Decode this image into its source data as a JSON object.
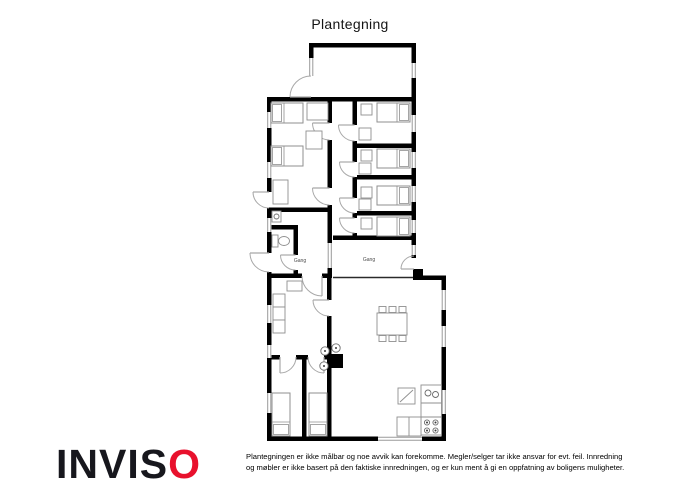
{
  "header": {
    "title": "Plantegning"
  },
  "footer": {
    "logo_text_black": "INVIS",
    "logo_text_red": "O",
    "logo_red_color": "#e8112d",
    "disclaimer_line1": "Plantegningen er ikke målbar og noe avvik kan forekomme. Megler/selger tar ikke ansvar for evt. feil. Innredning",
    "disclaimer_line2": "og møbler er ikke basert på den faktiske innredningen, og er kun ment å gi en oppfatning av boligens muligheter."
  },
  "floorplan": {
    "wall_color": "#000000",
    "window_color": "#9a9a9a",
    "door_color": "#a8a8a8",
    "furniture_color": "#8f8f8f",
    "label_color": "#4a4a4a",
    "walls": [
      {
        "x": 309,
        "y": 43,
        "w": 107,
        "h": 4.5
      },
      {
        "x": 309,
        "y": 47.5,
        "w": 4.5,
        "h": 10.5
      },
      {
        "x": 411.5,
        "y": 47.5,
        "w": 4.5,
        "h": 15.5
      },
      {
        "x": 411.5,
        "y": 78,
        "w": 4.5,
        "h": 19
      },
      {
        "x": 267,
        "y": 97,
        "w": 149,
        "h": 4.5
      },
      {
        "x": 267,
        "y": 101.5,
        "w": 4.5,
        "h": 10.5
      },
      {
        "x": 267,
        "y": 128,
        "w": 4.5,
        "h": 34
      },
      {
        "x": 267,
        "y": 178,
        "w": 4.5,
        "h": 14
      },
      {
        "x": 267,
        "y": 208,
        "w": 4.5,
        "h": 10
      },
      {
        "x": 267,
        "y": 232,
        "w": 4.5,
        "h": 21
      },
      {
        "x": 267,
        "y": 272,
        "w": 4.5,
        "h": 33
      },
      {
        "x": 267,
        "y": 323,
        "w": 4.5,
        "h": 22
      },
      {
        "x": 267,
        "y": 358,
        "w": 4.5,
        "h": 35
      },
      {
        "x": 267,
        "y": 413,
        "w": 4.5,
        "h": 28
      },
      {
        "x": 267,
        "y": 436.5,
        "w": 111,
        "h": 4.5
      },
      {
        "x": 422,
        "y": 436.5,
        "w": 24,
        "h": 4.5
      },
      {
        "x": 441.5,
        "y": 275.5,
        "w": 4.5,
        "h": 14.5
      },
      {
        "x": 441.5,
        "y": 310,
        "w": 4.5,
        "h": 16
      },
      {
        "x": 441.5,
        "y": 347,
        "w": 4.5,
        "h": 43
      },
      {
        "x": 441.5,
        "y": 414,
        "w": 4.5,
        "h": 27
      },
      {
        "x": 413,
        "y": 275.5,
        "w": 33,
        "h": 4.5
      },
      {
        "x": 413,
        "y": 269,
        "w": 10,
        "h": 11
      },
      {
        "x": 411.5,
        "y": 101.5,
        "w": 4.5,
        "h": 13.5
      },
      {
        "x": 411.5,
        "y": 132,
        "w": 4.5,
        "h": 20
      },
      {
        "x": 411.5,
        "y": 168,
        "w": 4.5,
        "h": 18
      },
      {
        "x": 411.5,
        "y": 202,
        "w": 4.5,
        "h": 18
      },
      {
        "x": 411.5,
        "y": 233,
        "w": 4.5,
        "h": 12
      },
      {
        "x": 411.5,
        "y": 255,
        "w": 4.5,
        "h": 3
      },
      {
        "x": 327.5,
        "y": 101.5,
        "w": 4.5,
        "h": 21.5
      },
      {
        "x": 327.5,
        "y": 140,
        "w": 4.5,
        "h": 48
      },
      {
        "x": 327.5,
        "y": 205,
        "w": 4.5,
        "h": 7
      },
      {
        "x": 267,
        "y": 207.5,
        "w": 60.5,
        "h": 4.5
      },
      {
        "x": 352.5,
        "y": 101.5,
        "w": 4.5,
        "h": 23.5
      },
      {
        "x": 352.5,
        "y": 141,
        "w": 4.5,
        "h": 21
      },
      {
        "x": 352.5,
        "y": 177,
        "w": 4.5,
        "h": 21
      },
      {
        "x": 352.5,
        "y": 213,
        "w": 4.5,
        "h": 5
      },
      {
        "x": 352.5,
        "y": 233,
        "w": 4.5,
        "h": 7
      },
      {
        "x": 357,
        "y": 143.5,
        "w": 54.5,
        "h": 4.5
      },
      {
        "x": 357,
        "y": 175,
        "w": 54.5,
        "h": 4.5
      },
      {
        "x": 357,
        "y": 211,
        "w": 54.5,
        "h": 4.5
      },
      {
        "x": 333,
        "y": 235.5,
        "w": 80,
        "h": 4.5
      },
      {
        "x": 327.5,
        "y": 212,
        "w": 4.5,
        "h": 31
      },
      {
        "x": 327.5,
        "y": 268,
        "w": 4.5,
        "h": 10
      },
      {
        "x": 267,
        "y": 225,
        "w": 31,
        "h": 4.5
      },
      {
        "x": 293.5,
        "y": 229.5,
        "w": 4.5,
        "h": 25.5
      },
      {
        "x": 293.5,
        "y": 270,
        "w": 4.5,
        "h": 8
      },
      {
        "x": 267,
        "y": 273.5,
        "w": 35,
        "h": 4.5
      },
      {
        "x": 322,
        "y": 273.5,
        "w": 10,
        "h": 4.5
      },
      {
        "x": 327,
        "y": 278,
        "w": 4.5,
        "h": 22
      },
      {
        "x": 327,
        "y": 316,
        "w": 4.5,
        "h": 39
      },
      {
        "x": 327,
        "y": 355,
        "w": 4.5,
        "h": 82
      },
      {
        "x": 267,
        "y": 355,
        "w": 13,
        "h": 4.5
      },
      {
        "x": 296,
        "y": 355,
        "w": 12,
        "h": 4.5
      },
      {
        "x": 324,
        "y": 355,
        "w": 7.5,
        "h": 4.5
      },
      {
        "x": 302,
        "y": 359.5,
        "w": 4.5,
        "h": 77
      }
    ],
    "windows": [
      {
        "x": 309,
        "y": 58,
        "w": 4.5,
        "h": 18
      },
      {
        "x": 411.5,
        "y": 63,
        "w": 4.5,
        "h": 15
      },
      {
        "x": 267,
        "y": 112,
        "w": 4.5,
        "h": 16
      },
      {
        "x": 267,
        "y": 162,
        "w": 4.5,
        "h": 16
      },
      {
        "x": 267,
        "y": 218,
        "w": 4.5,
        "h": 14
      },
      {
        "x": 267,
        "y": 305,
        "w": 4.5,
        "h": 18
      },
      {
        "x": 267,
        "y": 345,
        "w": 4.5,
        "h": 13
      },
      {
        "x": 267,
        "y": 393,
        "w": 4.5,
        "h": 20
      },
      {
        "x": 411.5,
        "y": 115,
        "w": 4.5,
        "h": 17
      },
      {
        "x": 411.5,
        "y": 152,
        "w": 4.5,
        "h": 16
      },
      {
        "x": 411.5,
        "y": 186,
        "w": 4.5,
        "h": 16
      },
      {
        "x": 411.5,
        "y": 220,
        "w": 4.5,
        "h": 13
      },
      {
        "x": 411.5,
        "y": 245,
        "w": 4.5,
        "h": 10
      },
      {
        "x": 441.5,
        "y": 290,
        "w": 4.5,
        "h": 20
      },
      {
        "x": 441.5,
        "y": 326,
        "w": 4.5,
        "h": 21
      },
      {
        "x": 441.5,
        "y": 390,
        "w": 4.5,
        "h": 24
      },
      {
        "x": 327.5,
        "y": 243,
        "w": 4.5,
        "h": 25
      },
      {
        "x": 378,
        "y": 436.5,
        "w": 44,
        "h": 4.5
      }
    ],
    "doors": [
      {
        "cx": 311,
        "cy": 97,
        "r": 21,
        "a1": -90,
        "a2": 180
      },
      {
        "cx": 269,
        "cy": 192,
        "r": 16,
        "a1": 90,
        "a2": 180
      },
      {
        "cx": 269,
        "cy": 253,
        "r": 19,
        "a1": 90,
        "a2": 180
      },
      {
        "cx": 414,
        "cy": 269,
        "r": 13,
        "a1": -90,
        "a2": 180
      },
      {
        "cx": 329.5,
        "cy": 123,
        "r": 17,
        "a1": 90,
        "a2": 180
      },
      {
        "cx": 354.5,
        "cy": 125,
        "r": 16,
        "a1": 90,
        "a2": 180
      },
      {
        "cx": 354.5,
        "cy": 162,
        "r": 15,
        "a1": 90,
        "a2": 180
      },
      {
        "cx": 354.5,
        "cy": 198,
        "r": 15,
        "a1": 90,
        "a2": 180
      },
      {
        "cx": 354.5,
        "cy": 218,
        "r": 15,
        "a1": 90,
        "a2": 180
      },
      {
        "cx": 329.5,
        "cy": 188,
        "r": 17,
        "a1": 90,
        "a2": 180
      },
      {
        "cx": 295.5,
        "cy": 255,
        "r": 15,
        "a1": 90,
        "a2": 180
      },
      {
        "cx": 322,
        "cy": 276,
        "r": 20,
        "a1": 180,
        "a2": 90
      },
      {
        "cx": 329,
        "cy": 300,
        "r": 16,
        "a1": 90,
        "a2": 180
      },
      {
        "cx": 280,
        "cy": 357,
        "r": 16,
        "a1": 0,
        "a2": 90
      },
      {
        "cx": 324,
        "cy": 357,
        "r": 16,
        "a1": 180,
        "a2": 90
      }
    ],
    "thin_lines": [
      {
        "x1": 333,
        "y1": 277.5,
        "x2": 413,
        "y2": 277.5
      }
    ],
    "labels": [
      {
        "text": "Gang",
        "x": 300,
        "y": 262
      },
      {
        "text": "Gang",
        "x": 369,
        "y": 261
      }
    ],
    "furniture": [
      {
        "type": "bed",
        "name": "bed",
        "x": 271,
        "y": 103,
        "w": 32,
        "h": 20,
        "pillow": "left"
      },
      {
        "type": "bed",
        "name": "bed",
        "x": 271,
        "y": 146,
        "w": 32,
        "h": 20,
        "pillow": "left"
      },
      {
        "type": "bed",
        "name": "bed",
        "x": 377,
        "y": 103,
        "w": 33,
        "h": 19,
        "pillow": "right"
      },
      {
        "type": "bed",
        "name": "bed",
        "x": 377,
        "y": 149,
        "w": 33,
        "h": 19,
        "pillow": "right"
      },
      {
        "type": "bed",
        "name": "bed",
        "x": 377,
        "y": 186,
        "w": 33,
        "h": 19,
        "pillow": "right"
      },
      {
        "type": "bed",
        "name": "bed",
        "x": 377,
        "y": 217,
        "w": 33,
        "h": 19,
        "pillow": "right"
      },
      {
        "type": "bed",
        "name": "bed",
        "x": 272,
        "y": 393,
        "w": 18,
        "h": 43,
        "pillow": "bottom"
      },
      {
        "type": "bed",
        "name": "bed",
        "x": 309,
        "y": 393,
        "w": 18,
        "h": 43,
        "pillow": "bottom"
      },
      {
        "type": "rect",
        "name": "side-table",
        "x": 307,
        "y": 103,
        "w": 21,
        "h": 17
      },
      {
        "type": "rect",
        "name": "desk",
        "x": 306,
        "y": 131,
        "w": 16,
        "h": 18
      },
      {
        "type": "rect",
        "name": "wardrobe",
        "x": 273,
        "y": 180,
        "w": 15,
        "h": 24
      },
      {
        "type": "rect",
        "name": "nightstand",
        "x": 361,
        "y": 104,
        "w": 11,
        "h": 11
      },
      {
        "type": "rect",
        "name": "nightstand",
        "x": 361,
        "y": 150,
        "w": 11,
        "h": 11
      },
      {
        "type": "rect",
        "name": "nightstand",
        "x": 361,
        "y": 187,
        "w": 11,
        "h": 11
      },
      {
        "type": "rect",
        "name": "nightstand",
        "x": 361,
        "y": 218,
        "w": 11,
        "h": 11
      },
      {
        "type": "rect",
        "name": "wardrobe",
        "x": 359,
        "y": 128,
        "w": 12,
        "h": 12
      },
      {
        "type": "rect",
        "name": "wardrobe",
        "x": 359,
        "y": 163,
        "w": 12,
        "h": 11
      },
      {
        "type": "rect",
        "name": "wardrobe",
        "x": 359,
        "y": 199,
        "w": 12,
        "h": 11
      },
      {
        "type": "rect",
        "name": "shelf",
        "x": 287,
        "y": 281,
        "w": 15,
        "h": 10
      },
      {
        "type": "rect",
        "name": "cabinet",
        "x": 273,
        "y": 294,
        "w": 12,
        "h": 13
      },
      {
        "type": "rect",
        "name": "cabinet",
        "x": 273,
        "y": 307,
        "w": 12,
        "h": 13
      },
      {
        "type": "rect",
        "name": "cabinet",
        "x": 273,
        "y": 320,
        "w": 12,
        "h": 13
      },
      {
        "type": "rect",
        "name": "sink-unit",
        "x": 272,
        "y": 211,
        "w": 9,
        "h": 11
      },
      {
        "type": "circle",
        "name": "sink",
        "cx": 276.5,
        "cy": 216.5,
        "r": 2.5
      },
      {
        "type": "rect",
        "name": "toilet-tank",
        "x": 272,
        "y": 235,
        "w": 6,
        "h": 12
      },
      {
        "type": "ellipse",
        "name": "toilet-bowl",
        "cx": 284,
        "cy": 241,
        "rx": 5.5,
        "ry": 4.5
      },
      {
        "type": "rect",
        "name": "dining-table",
        "x": 377,
        "y": 313,
        "w": 30,
        "h": 22
      },
      {
        "type": "rect",
        "name": "chair",
        "x": 379,
        "y": 306.5,
        "w": 7,
        "h": 6
      },
      {
        "type": "rect",
        "name": "chair",
        "x": 389,
        "y": 306.5,
        "w": 7,
        "h": 6
      },
      {
        "type": "rect",
        "name": "chair",
        "x": 399,
        "y": 306.5,
        "w": 7,
        "h": 6
      },
      {
        "type": "rect",
        "name": "chair",
        "x": 379,
        "y": 335.5,
        "w": 7,
        "h": 6
      },
      {
        "type": "rect",
        "name": "chair",
        "x": 389,
        "y": 335.5,
        "w": 7,
        "h": 6
      },
      {
        "type": "rect",
        "name": "chair",
        "x": 399,
        "y": 335.5,
        "w": 7,
        "h": 6
      },
      {
        "type": "frect",
        "name": "chimney",
        "x": 330,
        "y": 354,
        "w": 13,
        "h": 14
      },
      {
        "type": "circle",
        "name": "wood-stove",
        "cx": 325,
        "cy": 351,
        "r": 4.2,
        "dot": true
      },
      {
        "type": "circle",
        "name": "wood-stove",
        "cx": 336,
        "cy": 348,
        "r": 4.2,
        "dot": true
      },
      {
        "type": "circle",
        "name": "wood-stove",
        "cx": 324,
        "cy": 366,
        "r": 4.2,
        "dot": true
      },
      {
        "type": "rect",
        "name": "kitchen-counter",
        "x": 421,
        "y": 385,
        "w": 20.5,
        "h": 50
      },
      {
        "type": "line",
        "name": "counter-divider",
        "x1": 421,
        "y1": 403,
        "x2": 441.5,
        "y2": 403
      },
      {
        "type": "line",
        "name": "counter-divider",
        "x1": 421,
        "y1": 417,
        "x2": 441.5,
        "y2": 417
      },
      {
        "type": "circle",
        "name": "kitchen-sink",
        "cx": 428,
        "cy": 393,
        "r": 3
      },
      {
        "type": "circle",
        "name": "kitchen-sink",
        "cx": 435.5,
        "cy": 394.5,
        "r": 3
      },
      {
        "type": "rect",
        "name": "kitchen-counter",
        "x": 397,
        "y": 417,
        "w": 24,
        "h": 19
      },
      {
        "type": "line",
        "name": "counter-divider",
        "x1": 409,
        "y1": 417,
        "x2": 409,
        "y2": 436
      },
      {
        "type": "circle",
        "name": "stove-burner",
        "cx": 427,
        "cy": 422.5,
        "r": 2.6,
        "dot": true
      },
      {
        "type": "circle",
        "name": "stove-burner",
        "cx": 435.5,
        "cy": 422.5,
        "r": 2.6,
        "dot": true
      },
      {
        "type": "circle",
        "name": "stove-burner",
        "cx": 427,
        "cy": 430.5,
        "r": 2.6,
        "dot": true
      },
      {
        "type": "circle",
        "name": "stove-burner",
        "cx": 435.5,
        "cy": 430.5,
        "r": 2.6,
        "dot": true
      },
      {
        "type": "rect",
        "name": "small-table",
        "x": 398,
        "y": 388,
        "w": 17,
        "h": 16
      },
      {
        "type": "line",
        "name": "small-table-mark",
        "x1": 400,
        "y1": 402,
        "x2": 413,
        "y2": 390
      }
    ]
  }
}
